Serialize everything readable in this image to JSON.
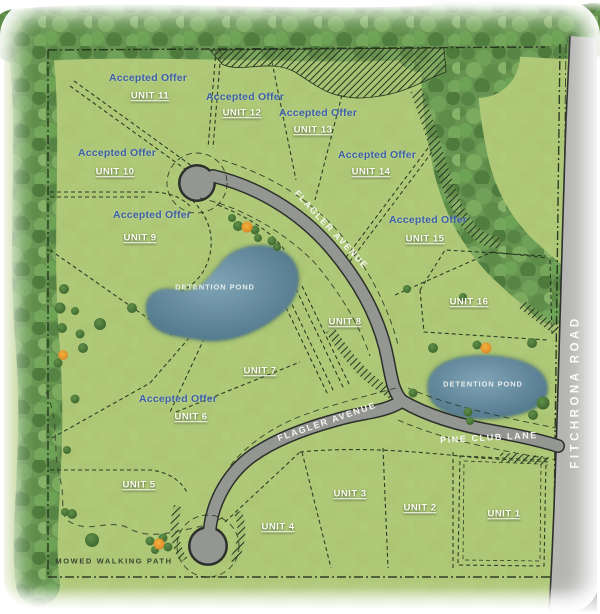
{
  "labels": {
    "accepted_offer": "Accepted Offer",
    "detention_pond": "DETENTION POND",
    "mowed_walking_path": "MOWED WALKING PATH"
  },
  "units": [
    {
      "label": "UNIT 1",
      "accepted_offer": false
    },
    {
      "label": "UNIT 2",
      "accepted_offer": false
    },
    {
      "label": "UNIT 3",
      "accepted_offer": false
    },
    {
      "label": "UNIT 4",
      "accepted_offer": false
    },
    {
      "label": "UNIT 5",
      "accepted_offer": false
    },
    {
      "label": "UNIT 6",
      "accepted_offer": true
    },
    {
      "label": "UNIT 7",
      "accepted_offer": false
    },
    {
      "label": "UNIT 8",
      "accepted_offer": false
    },
    {
      "label": "UNIT 9",
      "accepted_offer": true
    },
    {
      "label": "UNIT 10",
      "accepted_offer": true
    },
    {
      "label": "UNIT 11",
      "accepted_offer": true
    },
    {
      "label": "UNIT 12",
      "accepted_offer": true
    },
    {
      "label": "UNIT 13",
      "accepted_offer": true
    },
    {
      "label": "UNIT 14",
      "accepted_offer": true
    },
    {
      "label": "UNIT 15",
      "accepted_offer": true
    },
    {
      "label": "UNIT 16",
      "accepted_offer": false
    }
  ],
  "roads": {
    "flagler": "FLAGLER AVENUE",
    "pine_club": "PINE CLUB LANE",
    "fitchrona": "FITCHRONA ROAD"
  },
  "colors": {
    "grass": "#b2cb79",
    "forest": "#679551",
    "road": "#949692",
    "fitchrona_road": "#b5b5b3",
    "pond": "#5e8498",
    "offer_text": "#3d5fa6",
    "unit_text": "#fdfdf4"
  }
}
